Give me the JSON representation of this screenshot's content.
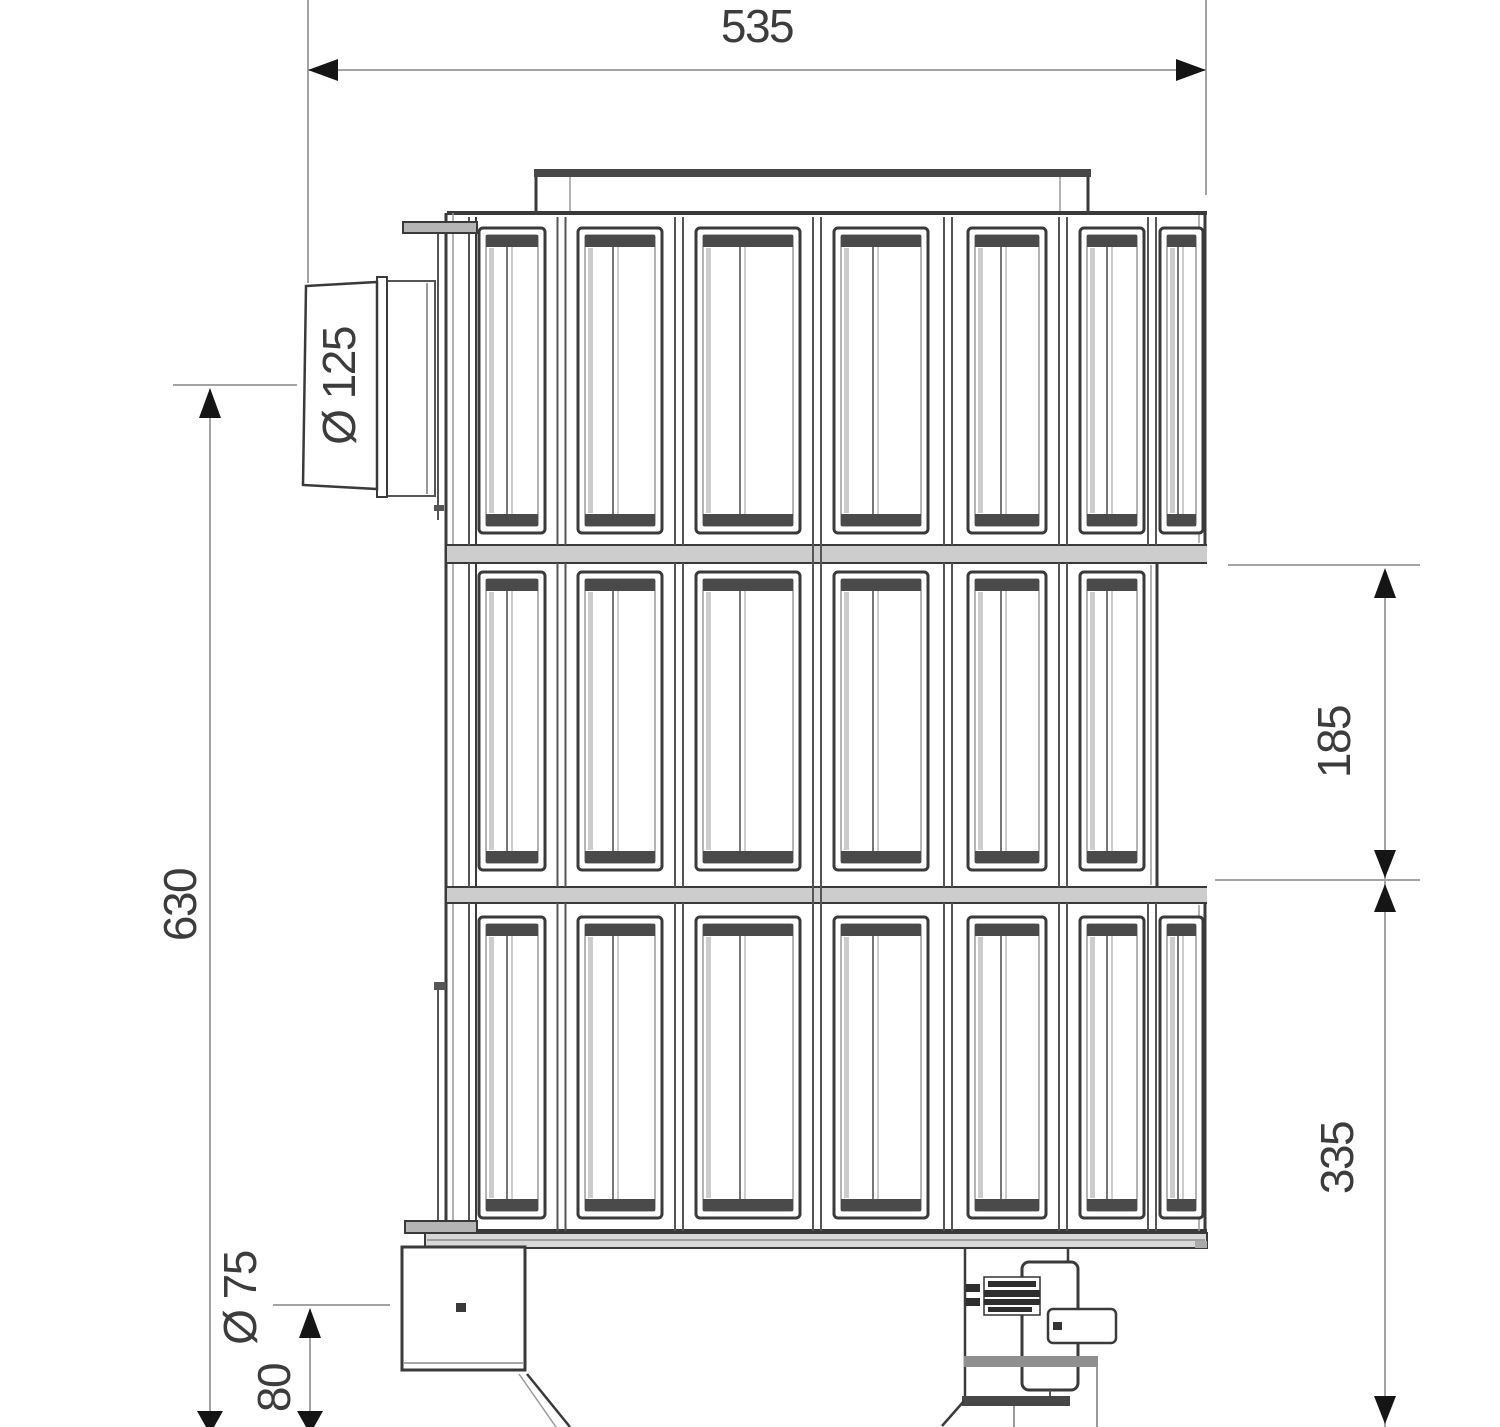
{
  "dimensions": {
    "overall_width": "535",
    "overall_height": "630",
    "flue_diameter": "Ø 125",
    "segment_pitch": "185",
    "lower_section_height": "335",
    "return_connection_diameter": "Ø 75",
    "drain_height": "80"
  },
  "figure": {
    "segment_rows": 3,
    "segment_columns": 6,
    "columns": [
      {
        "x": 479,
        "w": 66
      },
      {
        "x": 578,
        "w": 84
      },
      {
        "x": 696,
        "w": 104
      },
      {
        "x": 834,
        "w": 94
      },
      {
        "x": 968,
        "w": 78
      },
      {
        "x": 1080,
        "w": 64
      }
    ],
    "partial_column": {
      "x": 1160,
      "w": 43
    },
    "rows": [
      {
        "y": 228,
        "h": 305,
        "top": 217,
        "bottom": 545,
        "partial": true
      },
      {
        "y": 572,
        "h": 298,
        "top": 563,
        "bottom": 887,
        "partial": false
      },
      {
        "y": 917,
        "h": 301,
        "top": 903,
        "bottom": 1231,
        "partial": true
      }
    ]
  }
}
